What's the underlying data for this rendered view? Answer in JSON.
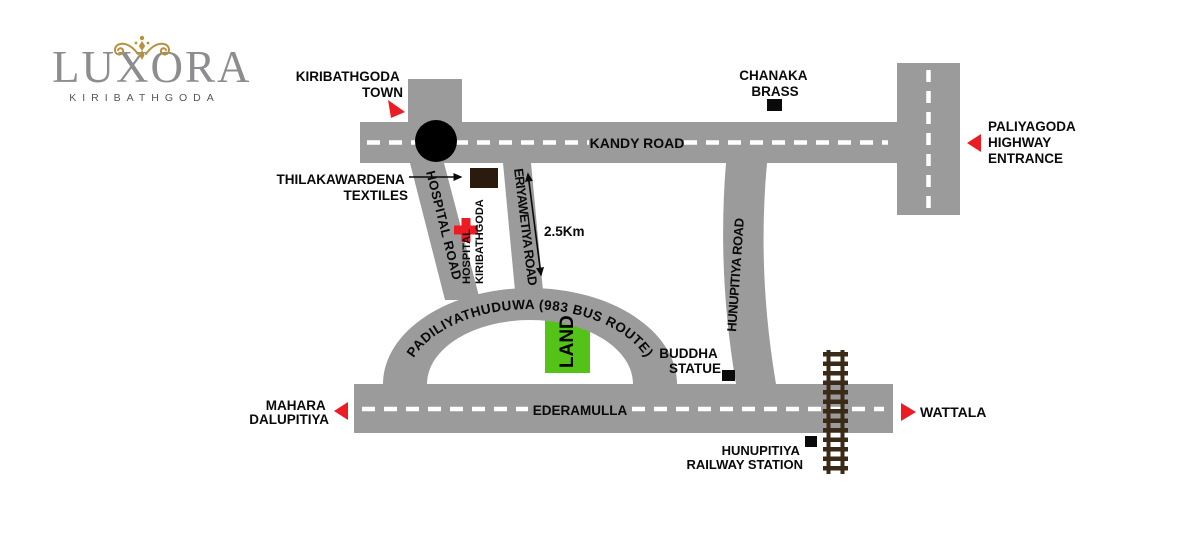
{
  "logo": {
    "brand": "LUXORA",
    "location": "KIRIBATHGODA"
  },
  "colors": {
    "road_gray": "#9b9b9b",
    "marker_red": "#ec1c24",
    "land_green": "#54c318",
    "rail_brown": "#3b2a18",
    "building_brown": "#2a1b0e",
    "brand_gray": "#8d8d8f",
    "brand_gold": "#b9903c",
    "centerline_white": "#ffffff",
    "label_black": "#0a0a0a"
  },
  "roads": {
    "kandy": {
      "label": "KANDY ROAD"
    },
    "ederamulla": {
      "label": "EDERAMULLA"
    },
    "hospital": {
      "label": "HOSPITAL ROAD"
    },
    "eriyawetiya": {
      "label": "ERIYAWETIYA ROAD"
    },
    "hunupitiya": {
      "label": "HUNUPITIYA ROAD"
    },
    "padiliyathuduwa": {
      "label": "PADILIYATHUDUWA (983 BUS ROUTE)"
    }
  },
  "places": {
    "town": {
      "line1": "KIRIBATHGODA",
      "line2": "TOWN"
    },
    "textiles": {
      "line1": "THILAKAWARDENA",
      "line2": "TEXTILES"
    },
    "brass": {
      "line1": "CHANAKA",
      "line2": "BRASS"
    },
    "highway": {
      "line1": "PALIYAGODA",
      "line2": "HIGHWAY",
      "line3": "ENTRANCE"
    },
    "hospital": {
      "line1": "HOSPITAL",
      "line2": "KIRIBATHGODA"
    },
    "buddha": {
      "line1": "BUDDHA",
      "line2": "STATUE"
    },
    "mahara": {
      "line1": "MAHARA",
      "line2": "DALUPITIYA"
    },
    "wattala": {
      "label": "WATTALA"
    },
    "station": {
      "line1": "HUNUPITIYA",
      "line2": "RAILWAY STATION"
    },
    "land": {
      "label": "LAND"
    },
    "distance": {
      "label": "2.5Km"
    }
  }
}
